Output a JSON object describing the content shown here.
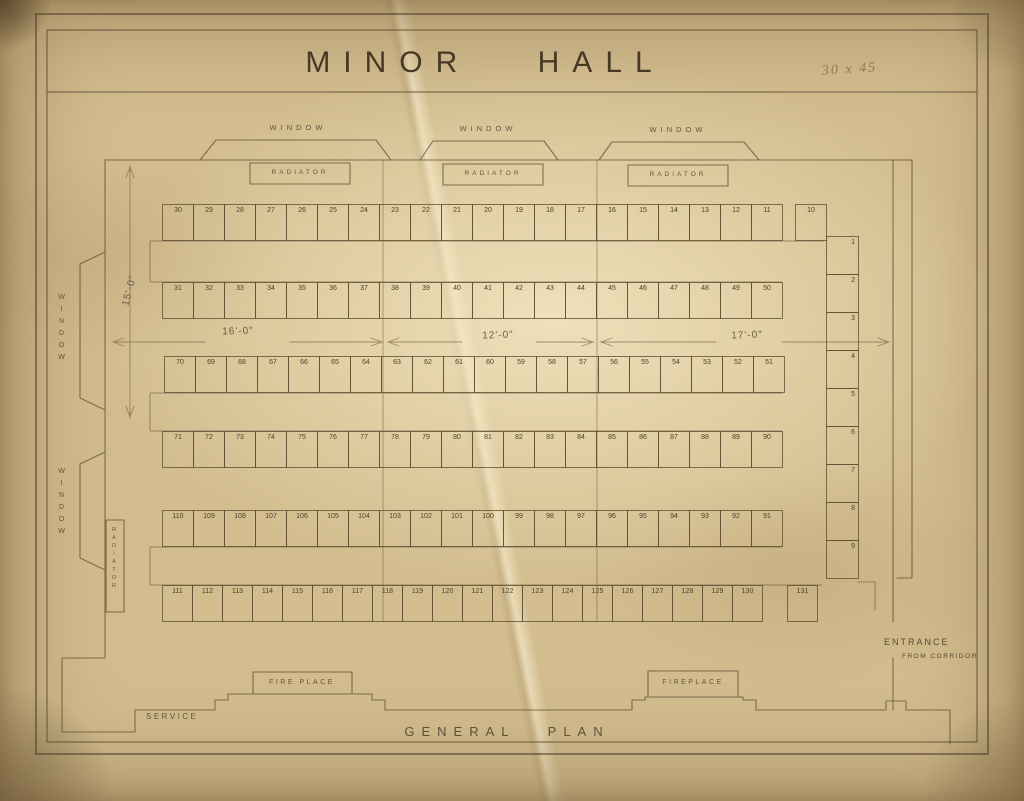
{
  "sheet": {
    "title": "MINOR HALL",
    "scale_note": "30 x 45",
    "plan_caption": "GENERAL PLAN"
  },
  "labels": {
    "window": "WINDOW",
    "radiator": "RADIATOR",
    "fireplace_left": "FIRE PLACE",
    "fireplace_right": "FIREPLACE",
    "service": "SERVICE",
    "entrance_line1": "ENTRANCE",
    "entrance_line2": "FROM CORRIDOR"
  },
  "dimensions": {
    "left_bay_width": "16'-0\"",
    "middle_bay_width": "12'-0\"",
    "right_bay_width": "17'-0\"",
    "hall_half_depth": "15'-0\""
  },
  "seat_rows": {
    "row1": [
      30,
      29,
      28,
      27,
      26,
      25,
      24,
      23,
      22,
      21,
      20,
      19,
      18,
      17,
      16,
      15,
      14,
      13,
      12,
      11,
      10
    ],
    "row2": [
      31,
      32,
      33,
      34,
      35,
      36,
      37,
      38,
      39,
      40,
      41,
      42,
      43,
      44,
      45,
      46,
      47,
      48,
      49,
      50
    ],
    "row3": [
      70,
      69,
      68,
      67,
      66,
      65,
      64,
      63,
      62,
      61,
      60,
      59,
      58,
      57,
      56,
      55,
      54,
      53,
      52,
      51
    ],
    "row4": [
      71,
      72,
      73,
      74,
      75,
      76,
      77,
      78,
      79,
      80,
      81,
      82,
      83,
      84,
      85,
      86,
      87,
      88,
      89,
      90
    ],
    "row5": [
      110,
      109,
      108,
      107,
      106,
      105,
      104,
      103,
      102,
      101,
      100,
      99,
      98,
      97,
      96,
      95,
      94,
      93,
      92,
      91
    ],
    "row6": [
      111,
      112,
      113,
      114,
      115,
      116,
      117,
      118,
      119,
      120,
      121,
      122,
      123,
      124,
      125,
      126,
      127,
      128,
      129,
      130,
      131
    ]
  },
  "side_column": [
    1,
    2,
    3,
    4,
    5,
    6,
    7,
    8,
    9
  ]
}
